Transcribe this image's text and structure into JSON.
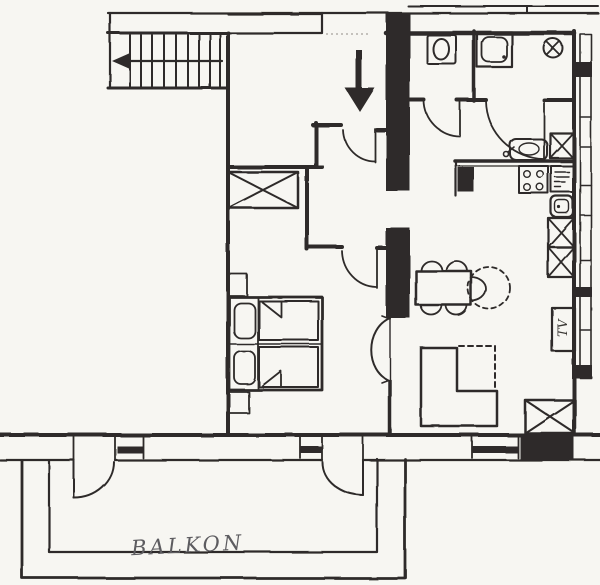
{
  "labels": {
    "balcony": "BALKON",
    "tv_cabinet": "TV"
  },
  "colors": {
    "paper": "#f7f6f2",
    "ink": "#2e2c29",
    "handwriting": "#5d5c60"
  },
  "plan": {
    "type": "hand-drawn apartment floor plan sketch",
    "symbols": [
      "staircase",
      "stair-direction-arrow",
      "entrance-arrow",
      "entry-threshold",
      "door-swing-arc",
      "wc-toilet",
      "shower-tray",
      "ceiling-light-circle-x",
      "kitchen-counter",
      "kitchen-sink",
      "stove-four-burners",
      "appliance-vents",
      "crossed-cabinet",
      "wardrobe-crossed",
      "twin-beds-with-pillows",
      "bedside-piers",
      "bedroom-door-arc",
      "dining-table-with-chairs",
      "dashed-extension-circle",
      "corner-sofa",
      "tv-cabinet",
      "facade-window-band",
      "bottom-wall-windows",
      "balcony-doors",
      "balcony-railing"
    ]
  }
}
